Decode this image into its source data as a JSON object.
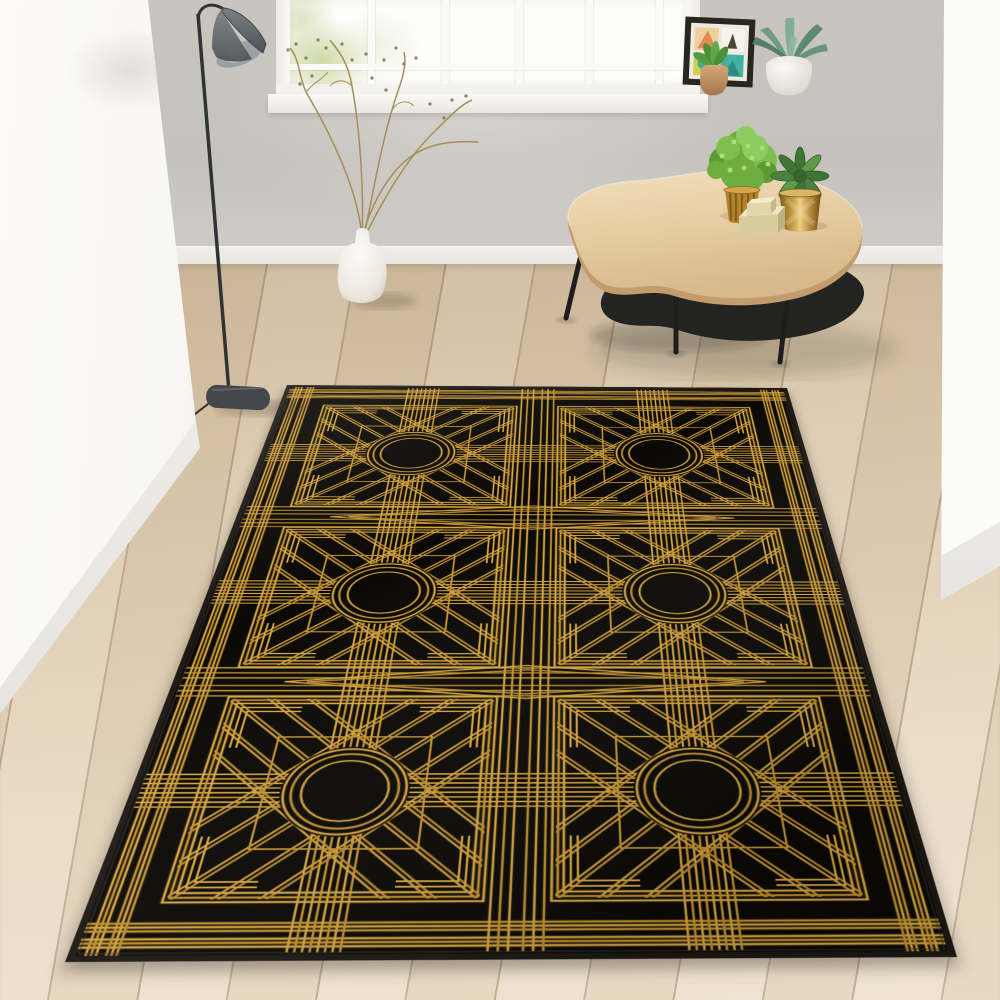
{
  "scene": {
    "setting": "bright minimalist living room with daylight from a white multi-pane window",
    "objects": [
      {
        "name": "art-deco-rug",
        "description": "black and gold art deco area rug, 2x3 grid of square medallions, each with concentric circle center, line bundles, diagonals and fretwork border"
      },
      {
        "name": "floor-lamp",
        "description": "dark grey metal floor lamp with slim leaning pole, conical shade facing down-left with visible warm bulb, rounded base and cord"
      },
      {
        "name": "ceramic-vase",
        "description": "white ceramic jug vase holding tall dried sprigs with tiny specks"
      },
      {
        "name": "coffee-table",
        "description": "kidney shaped light wood coffee table with black kidney lower shelf and splayed black legs"
      },
      {
        "name": "bushy-plant",
        "description": "round bushy green plant in ribbed mustard pot on table"
      },
      {
        "name": "succulent-gold-pot",
        "description": "green succulent rosette in faceted gold pot on table"
      },
      {
        "name": "trinket-box",
        "description": "small stacked cream box on table"
      },
      {
        "name": "books",
        "description": "two books stacked on the lower shelf"
      },
      {
        "name": "picture-frame",
        "description": "black square frame with mid-century abstract print leaning on windowsill"
      },
      {
        "name": "terracotta-pot-plant",
        "description": "small leafy plant in terracotta pot on windowsill"
      },
      {
        "name": "agave-plant",
        "description": "spiky agave in round white pot on windowsill"
      },
      {
        "name": "window",
        "description": "white framed window with six vertical panes and sill"
      },
      {
        "name": "wood-floor",
        "description": "light oak wide plank wooden floor laid diagonally"
      },
      {
        "name": "foreground-walls",
        "description": "blurred bright white wall edges at left and right"
      }
    ]
  },
  "colors": {
    "wall_back": "#c8c5bf",
    "wall_white": "#f8f7f4",
    "baseboard": "#e9e7e2",
    "floor_light": "#e9dac4",
    "floor_mid": "#dcc9ae",
    "floor_dark": "#cdb89b",
    "rug_black": "#0b0906",
    "rug_gold": "#d7a640",
    "rug_gold2": "#c3922f",
    "rug_binding": "#1d1a15",
    "table_wood": "#e9d5ae",
    "table_wood_edge": "#c29c6c",
    "shelf_black": "#232321",
    "plant_green": "#6fae3e",
    "pot_mustard": "#b3832c",
    "pot_gold": "#c9a24a",
    "vase_white": "#f6f4ef",
    "lamp_grey": "#53585c",
    "lamp_base": "#44474a",
    "bulb_warm": "#f4e7c6",
    "agave_green": "#6f9b82",
    "terracotta": "#c3916a",
    "art_teal": "#46b0a1",
    "art_chartreuse": "#ccd14f",
    "art_peach": "#f0cf9f",
    "art_orange": "#e08b52",
    "book_tan": "#b89a60",
    "book_dark": "#272b21"
  }
}
